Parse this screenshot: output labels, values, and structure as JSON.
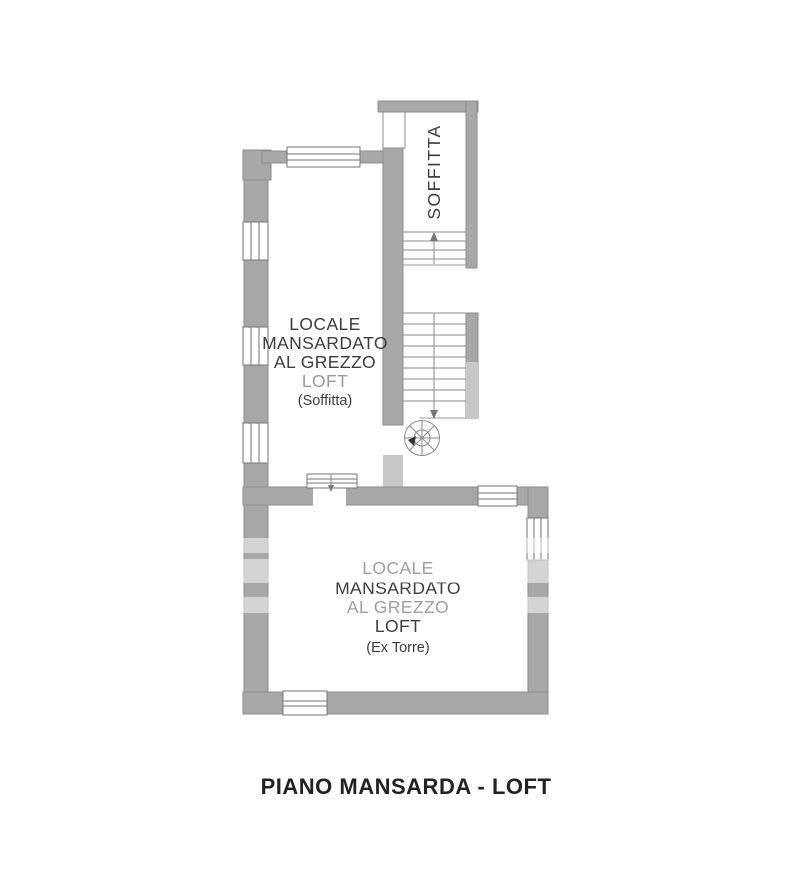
{
  "page": {
    "title": "PIANO MANSARDA - LOFT"
  },
  "rooms": {
    "soffitta": {
      "label": "SOFFITTA"
    },
    "upper_loft": {
      "lines": [
        "LOCALE",
        "MANSARDATO",
        "AL GREZZO",
        "LOFT"
      ],
      "note": "(Soffitta)"
    },
    "tower_loft": {
      "lines": [
        "LOCALE",
        "MANSARDATO",
        "AL GREZZO",
        "LOFT"
      ],
      "note": "(Ex Torre)"
    }
  },
  "colors": {
    "wall": "#a8a8a8",
    "wall_light": "#c8c8c8",
    "wall_outline": "#8d8d8d",
    "window_line": "#757575",
    "stair_line": "#8a8a8a",
    "label_text": "#3d3d3d",
    "muted_text": "#9a9a9a",
    "title_text": "#222222"
  }
}
